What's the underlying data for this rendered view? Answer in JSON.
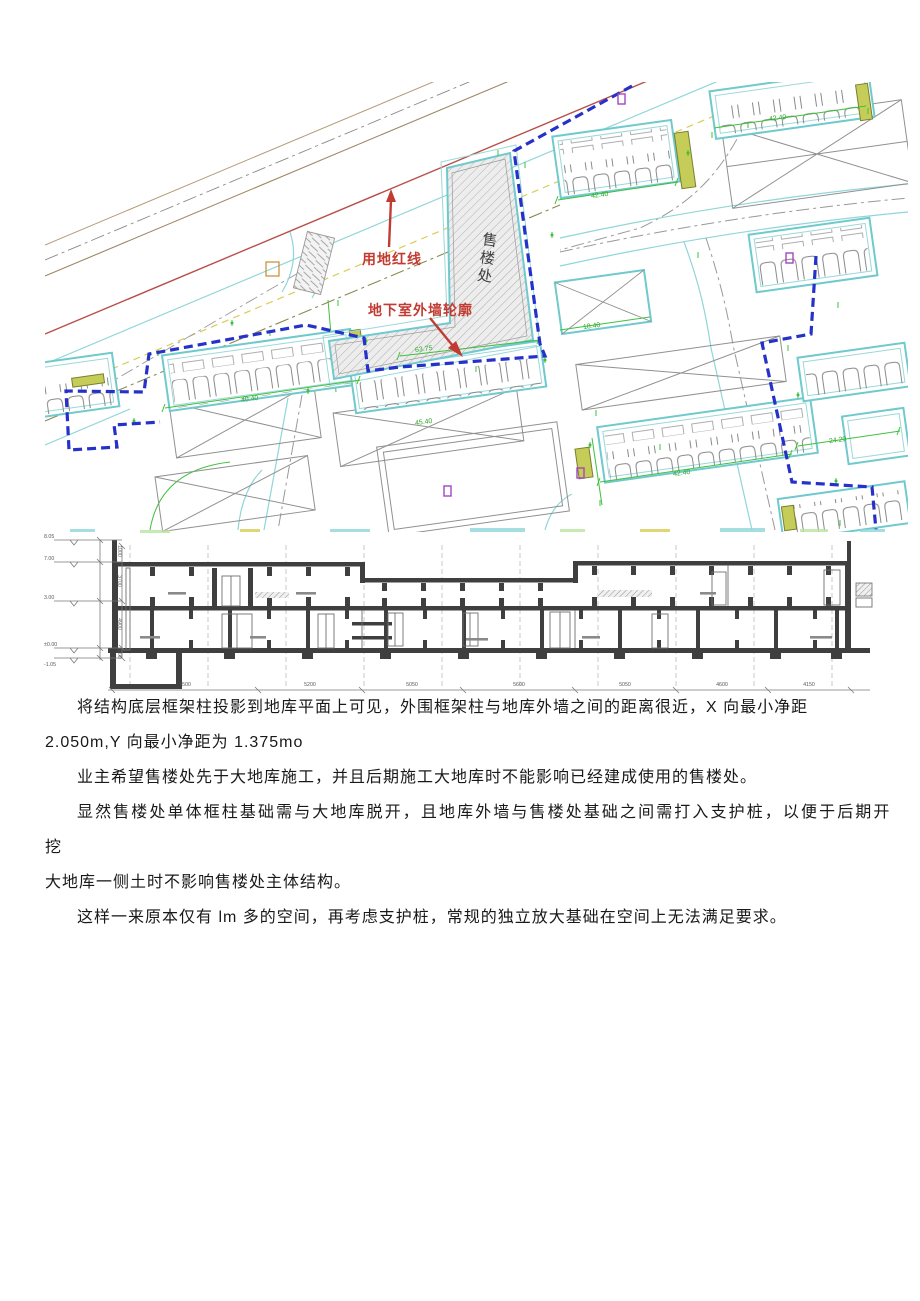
{
  "page": {
    "background": "#ffffff"
  },
  "site_plan": {
    "labels": {
      "land_red_line": "用地红线",
      "basement_wall_outline": "地下室外墙轮廓",
      "sales_office": "售楼处"
    },
    "dimensions": {
      "row_a": "42.40",
      "row_b": "42.40",
      "row_d": "40.40",
      "row_e": "42.40",
      "sales_office_edge": "63.75",
      "east_boundary": "24.29",
      "small_building": "18.40",
      "court": "45.40"
    },
    "colors": {
      "boundary_blue": "#2531c8",
      "building_cyan": "#6fc9cd",
      "dimension_green": "#3ec03e",
      "annotation_red": "#c23b32",
      "red_line": "#b8504a"
    }
  },
  "section": {
    "elevations": [
      "8.05",
      "7.00",
      "3.00",
      "±0.00",
      "-1.05"
    ],
    "story_dimensions": [
      "1000",
      "3700",
      "4900",
      "1000"
    ],
    "bay_dimensions": [
      "7500",
      "5200",
      "5050",
      "5600",
      "5050",
      "4600",
      "4150"
    ]
  },
  "document": {
    "lines": [
      "将结构底层框架柱投影到地库平面上可见，外围框架柱与地库外墙之间的距离很近，X 向最小净距",
      "2.050m,Y 向最小净距为 1.375mo",
      "业主希望售楼处先于大地库施工，并且后期施工大地库时不能影响已经建成使用的售楼处。",
      "显然售楼处单体框柱基础需与大地库脱开，且地库外墙与售楼处基础之间需打入支护桩，以便于后期开挖",
      "大地库一侧土时不影响售楼处主体结构。",
      "这样一来原本仅有 lm 多的空间，再考虑支护桩，常规的独立放大基础在空间上无法满足要求。"
    ]
  }
}
